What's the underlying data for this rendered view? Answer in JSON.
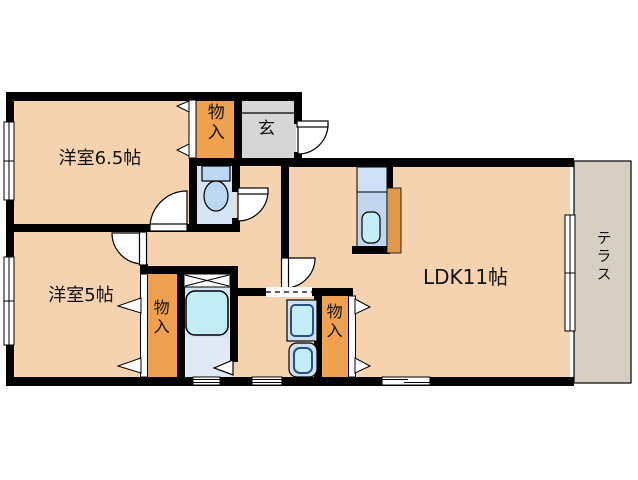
{
  "plan": {
    "rooms": {
      "western_6_5": {
        "label": "洋室6.5帖"
      },
      "western_5": {
        "label": "洋室5帖"
      },
      "ldk": {
        "label": "LDK11帖"
      },
      "entrance": {
        "label": "玄"
      },
      "terrace": {
        "label": "テラス"
      },
      "closet": {
        "label": "物入"
      }
    },
    "colors": {
      "floor": "#f5d2b0",
      "closet": "#f0a150",
      "entrance_floor": "#d6d6d6",
      "terrace_floor": "#d8cfc3",
      "wet_floor": "#d6e3f4",
      "bath_floor_light": "#e0eaf6",
      "fixture_blue": "#cfe0f2",
      "water_cyan": "#c3ecf6",
      "tank_blue": "#bcd7f2",
      "counter_top": "#cde0f5",
      "counter_body": "#c1d5ee",
      "kitchen_panel": "#e2974b",
      "wall": "#000000",
      "text": "#111111"
    }
  }
}
